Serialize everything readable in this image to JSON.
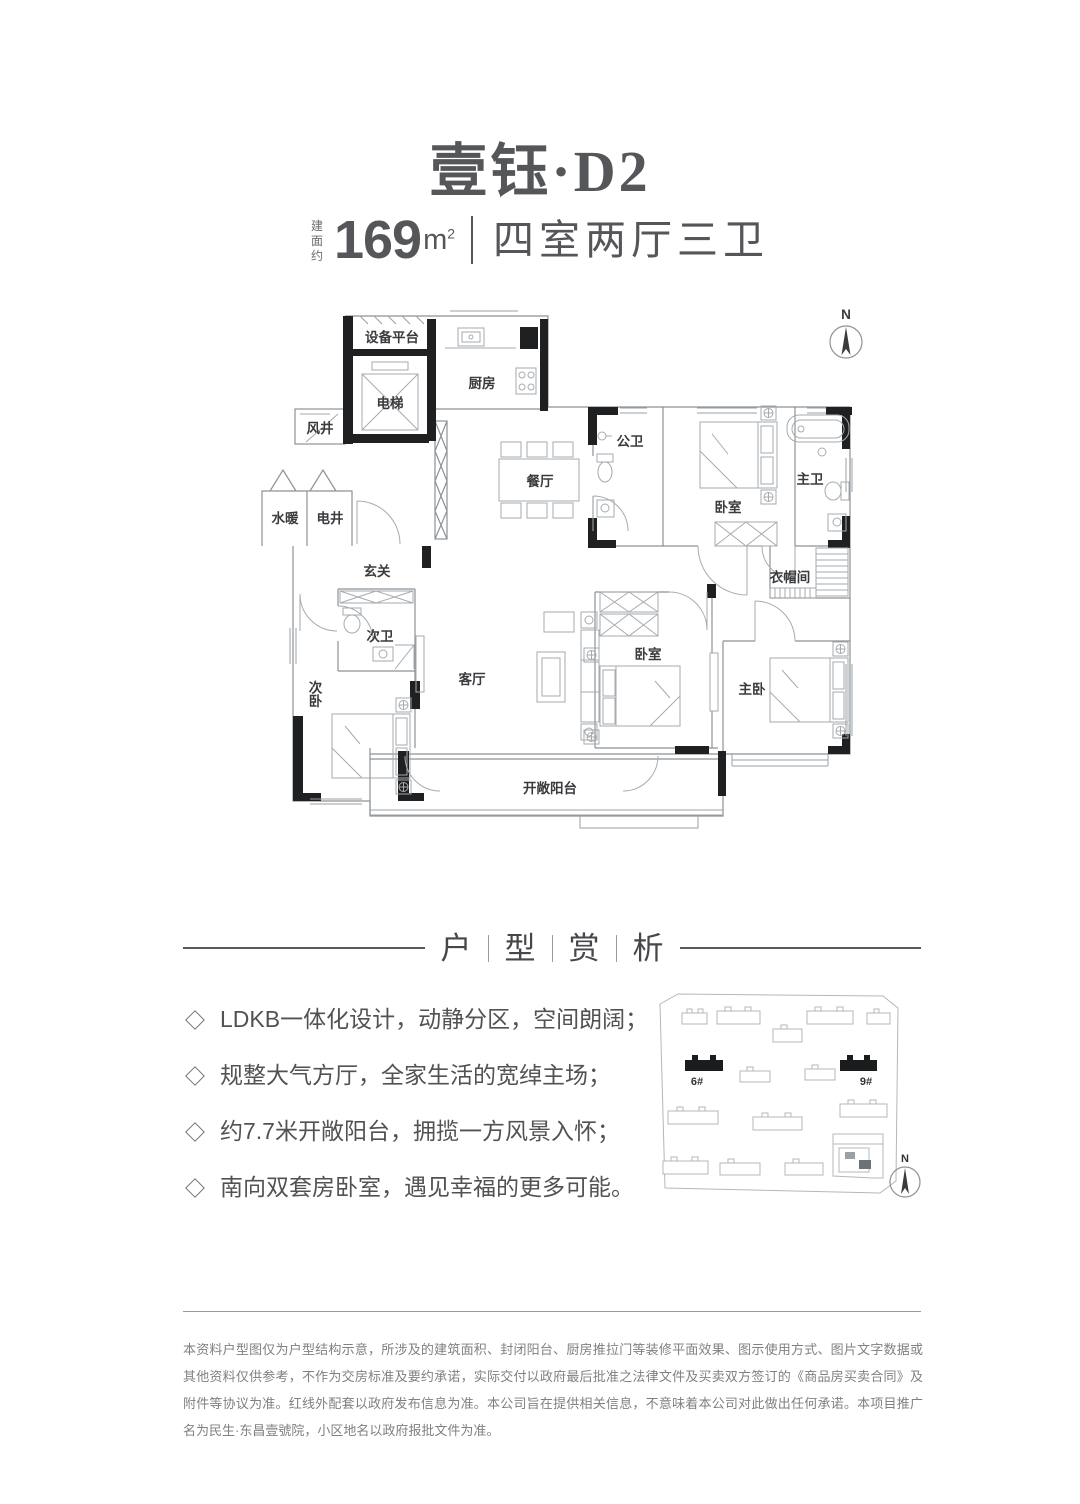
{
  "header": {
    "title": "壹钰·D2",
    "area_label": "建面约",
    "area_value": "169",
    "area_unit": "m",
    "area_unit_sup": "2",
    "layout_type": "四室两厅三卫"
  },
  "floorplan": {
    "north_label": "N",
    "rooms": {
      "equipment_platform": "设备平台",
      "elevator": "电梯",
      "kitchen": "厨房",
      "wind_shaft": "风井",
      "water_heating": "水暖",
      "electric_shaft": "电井",
      "dining_room": "餐厅",
      "public_bathroom": "公卫",
      "bedroom_north": "卧室",
      "master_bathroom": "主卫",
      "entry_hall": "玄关",
      "cloakroom": "衣帽间",
      "second_bathroom": "次卫",
      "second_bedroom": "次卧",
      "living_room": "客厅",
      "bedroom_south": "卧室",
      "master_bedroom": "主卧",
      "open_balcony": "开敞阳台"
    }
  },
  "analysis": {
    "heading_chars": [
      "户",
      "型",
      "赏",
      "析"
    ],
    "bullets": [
      "LDKB一体化设计，动静分区，空间朗阔；",
      "规整大气方厅，全家生活的宽绰主场；",
      "约7.7米开敞阳台，拥揽一方风景入怀；",
      "南向双套房卧室，遇见幸福的更多可能。"
    ]
  },
  "sitemap": {
    "building_6_label": "6#",
    "building_9_label": "9#",
    "north_label": "N"
  },
  "footer": {
    "disclaimer": "本资料户型图仅为户型结构示意，所涉及的建筑面积、封闭阳台、厨房推拉门等装修平面效果、图示使用方式、图片文字数据或其他资料仅供参考，不作为交房标准及要约承诺，实际交付以政府最后批准之法律文件及买卖双方签订的《商品房买卖合同》及附件等协议为准。红线外配套以政府发布信息为准。本公司旨在提供相关信息，不意味着本公司对此做出任何承诺。本项目推广名为民生·东昌壹號院，小区地名以政府报批文件为准。"
  },
  "colors": {
    "text_dark": "#55565a",
    "wall_black": "#1f2022",
    "line_gray": "#9aa0a5"
  }
}
